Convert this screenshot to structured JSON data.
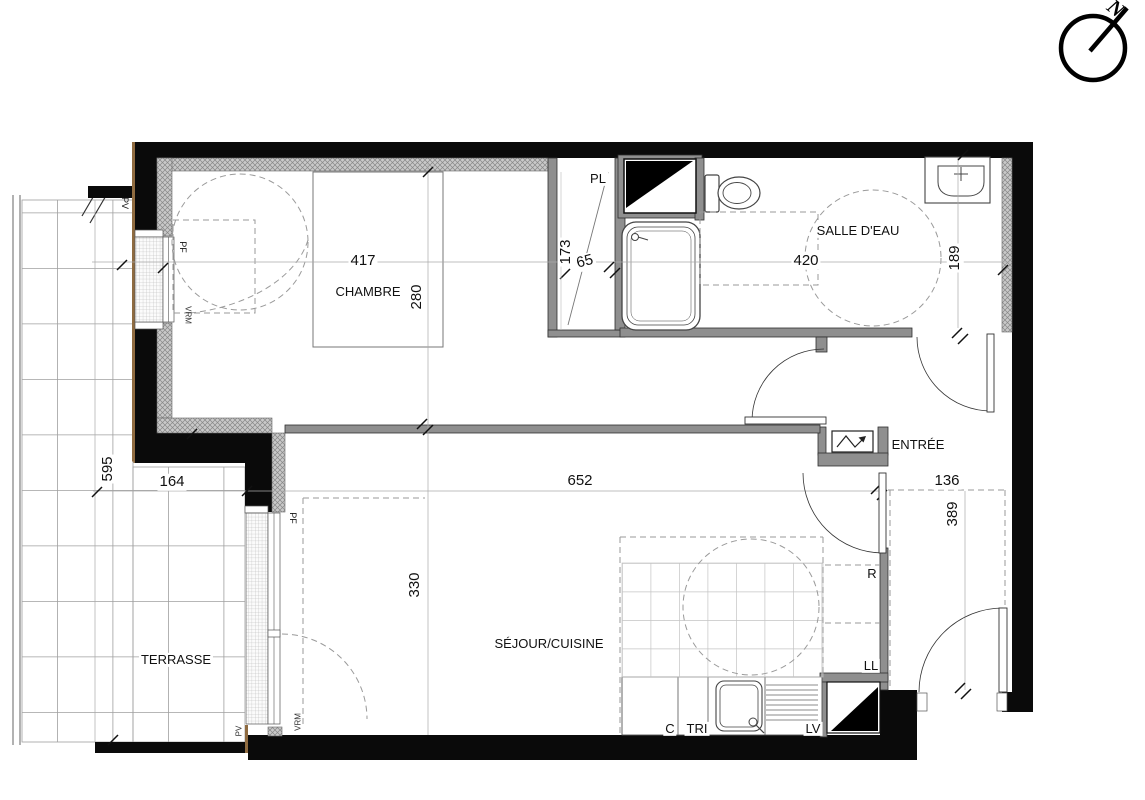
{
  "north": {
    "label": "N"
  },
  "rooms": {
    "chambre": {
      "name": "CHAMBRE",
      "width": "417",
      "depth": "280"
    },
    "placard": {
      "name": "PL",
      "width": "65",
      "depth": "173"
    },
    "salle_deau": {
      "name": "SALLE D'EAU",
      "width": "420",
      "depth": "189"
    },
    "entree": {
      "name": "ENTRÉE",
      "width": "136",
      "depth": "389"
    },
    "sejour_cuisine": {
      "name": "SÉJOUR/CUISINE",
      "width": "652",
      "depth": "330"
    },
    "terrasse": {
      "name": "TERRASSE",
      "width": "164",
      "depth": "595"
    }
  },
  "appliances": {
    "refrigerator": "R",
    "washing_machine": "LL",
    "cooktop": "C",
    "waste_sorting": "TRI",
    "dishwasher": "LV"
  },
  "joinery": {
    "window_door": "PF",
    "roller_shutter": "VRM",
    "glazed_panel": "PV"
  },
  "colors": {
    "wall": "#0a0a0a",
    "partition": "#8f8f8f",
    "hatch_fill": "#c9c9c9",
    "wood_trim": "#8f6b40"
  }
}
